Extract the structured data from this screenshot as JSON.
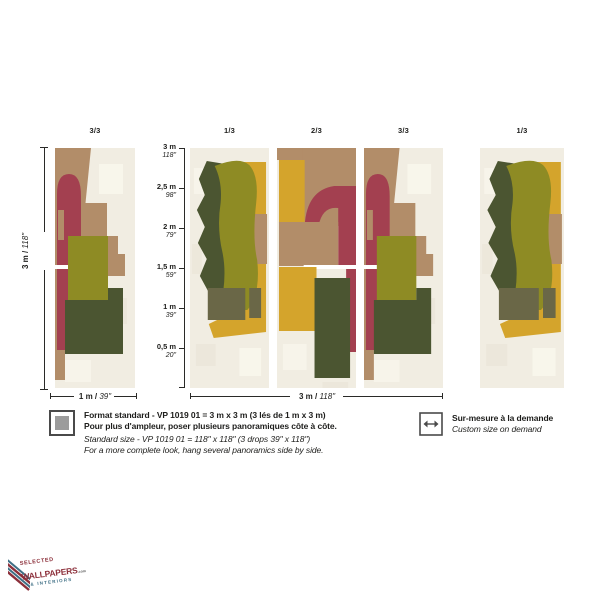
{
  "palette": {
    "cream": "#f1ede2",
    "tan": "#b28d69",
    "red": "#a34050",
    "olive": "#8e8b24",
    "dark_green": "#4b5531",
    "yellow": "#d4a42c",
    "dark_olive": "#6a6747",
    "seam": "#ffffff",
    "line": "#2a2a28",
    "icon_gray": "#9c9c9c",
    "icon_border": "#4a4a4a",
    "logo_red": "#8c2f3a",
    "logo_blue": "#3e6f85"
  },
  "top_labels": {
    "left": "3/3",
    "mid1": "1/3",
    "mid2": "2/3",
    "mid3": "3/3",
    "right": "1/3"
  },
  "dim_height": {
    "metric": "3 m /",
    "imperial": "118\""
  },
  "dim_width_single": {
    "metric": "1 m /",
    "imperial": "39\""
  },
  "dim_width_full": {
    "metric": "3 m /",
    "imperial": "118\""
  },
  "scale": [
    {
      "m": "3 m",
      "i": "118\""
    },
    {
      "m": "2,5 m",
      "i": "98\""
    },
    {
      "m": "2 m",
      "i": "79\""
    },
    {
      "m": "1,5 m",
      "i": "59\""
    },
    {
      "m": "1 m",
      "i": "39\""
    },
    {
      "m": "0,5 m",
      "i": "20\""
    }
  ],
  "info_left": {
    "fr1": "Format standard - VP 1019 01 = 3 m x 3 m (3 lés de 1 m x 3 m)",
    "fr2": "Pour plus d'ampleur, poser plusieurs panoramiques côte à côte.",
    "en1": "Standard size - VP 1019 01 = 118\" x 118\" (3 drops 39\" x 118\")",
    "en2": "For a more complete look, hang several panoramics side by side."
  },
  "info_right": {
    "fr": "Sur-mesure à la demande",
    "en": "Custom size on demand"
  },
  "logo": {
    "top": "SELECTED",
    "main": "WALLPAPERS",
    "suffix": ".com",
    "sub": "& INTERIORS"
  }
}
